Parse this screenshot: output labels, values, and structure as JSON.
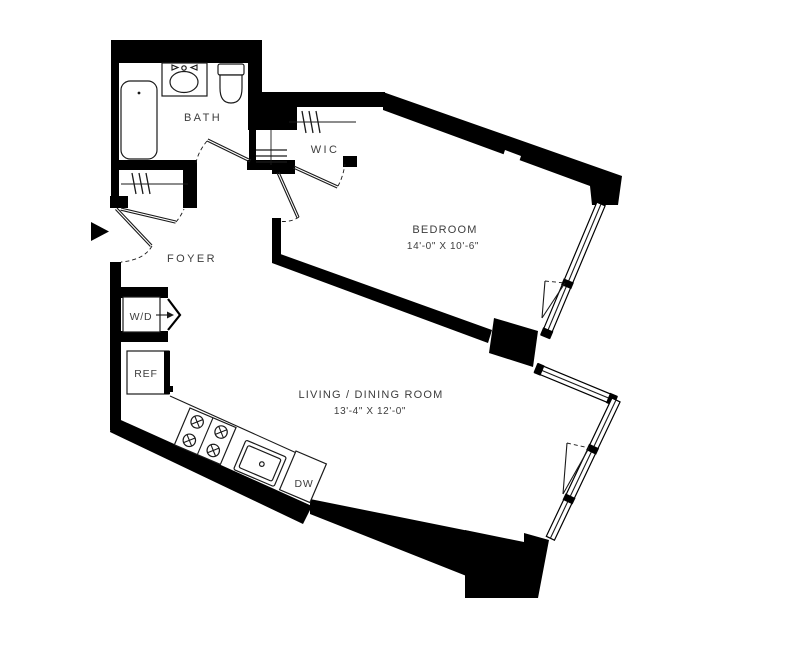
{
  "plan": {
    "rooms": {
      "bath": {
        "label": "BATH"
      },
      "wic": {
        "label": "WIC"
      },
      "foyer": {
        "label": "FOYER"
      },
      "bedroom": {
        "label": "BEDROOM",
        "dims": "14'-0\" X 10'-6\""
      },
      "living": {
        "label": "LIVING / DINING ROOM",
        "dims": "13'-4\" X 12'-0\""
      }
    },
    "appliances": {
      "washer_dryer": {
        "label": "W/D"
      },
      "refrigerator": {
        "label": "REF"
      },
      "dishwasher": {
        "label": "DW"
      }
    },
    "colors": {
      "wall": "#000000",
      "line": "#1a1a1a",
      "label": "#3d3d3d",
      "background": "#ffffff"
    }
  }
}
